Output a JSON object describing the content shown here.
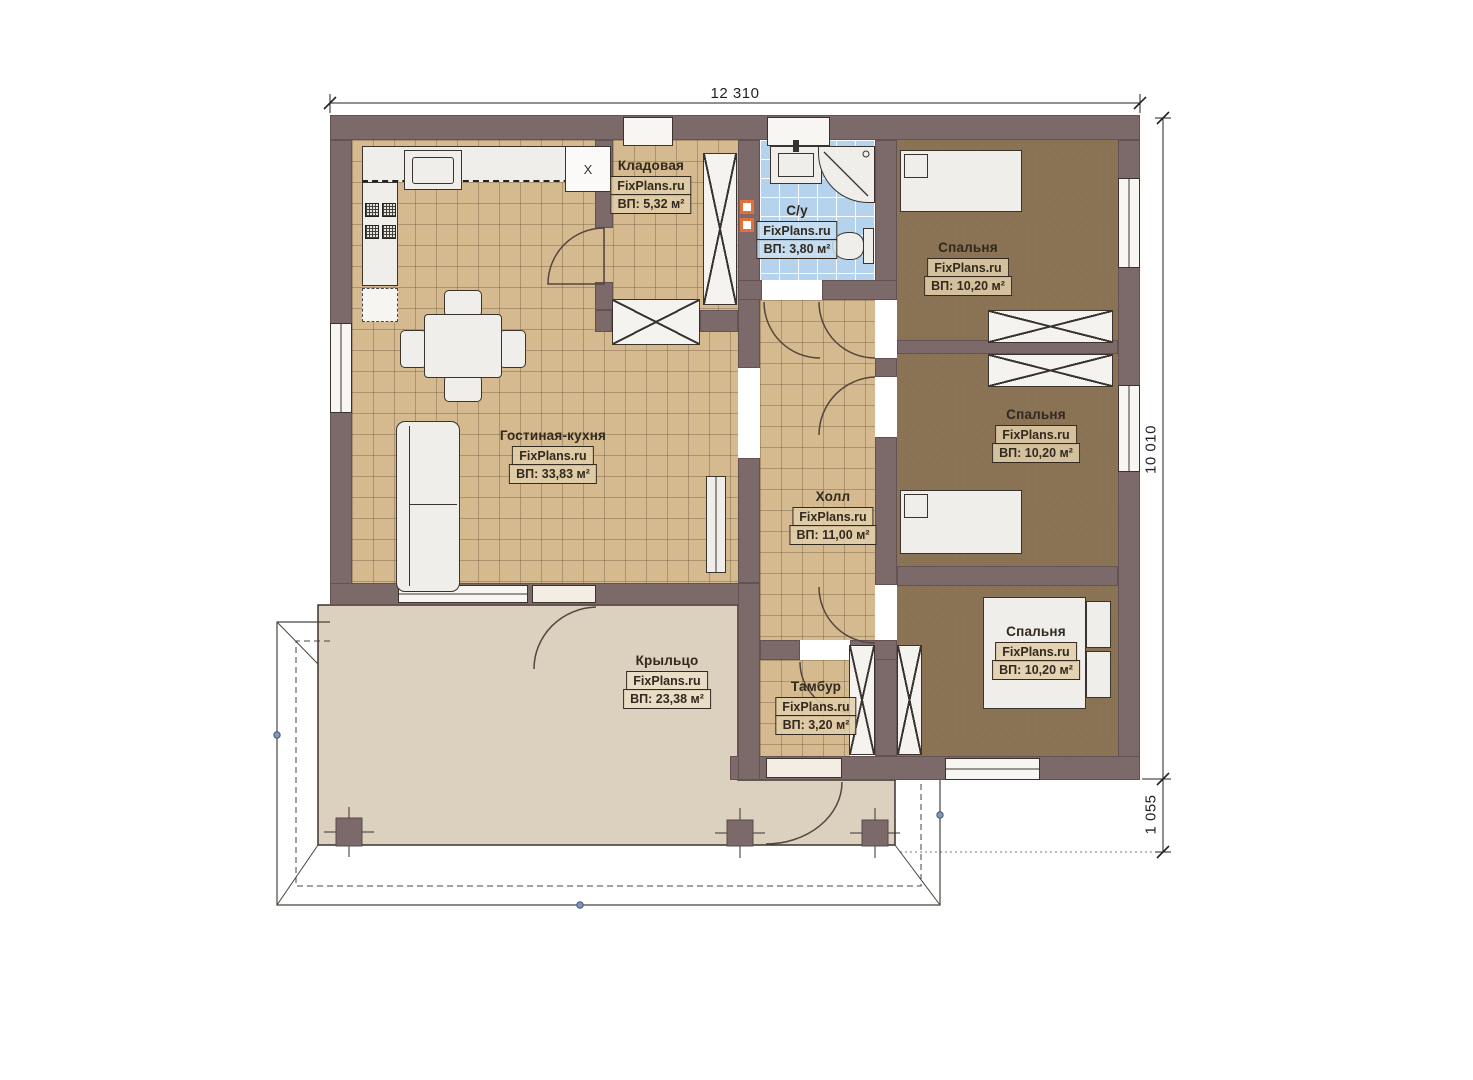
{
  "plan_type": "floor-plan",
  "watermark": "FixPlans.ru",
  "dimensions": {
    "top": "12 310",
    "right": "10 010",
    "bottom_right": "1 055"
  },
  "rooms": [
    {
      "id": "storage",
      "name": "Кладовая",
      "area": "ВП: 5,32 м²"
    },
    {
      "id": "bathroom",
      "name": "С/у",
      "area": "ВП: 3,80 м²"
    },
    {
      "id": "bedroom-1",
      "name": "Спальня",
      "area": "ВП: 10,20 м²"
    },
    {
      "id": "bedroom-2",
      "name": "Спальня",
      "area": "ВП: 10,20 м²"
    },
    {
      "id": "living-kitchen",
      "name": "Гостиная-кухня",
      "area": "ВП: 33,83 м²"
    },
    {
      "id": "hall",
      "name": "Холл",
      "area": "ВП: 11,00 м²"
    },
    {
      "id": "bedroom-3",
      "name": "Спальня",
      "area": "ВП: 10,20 м²"
    },
    {
      "id": "porch",
      "name": "Крыльцо",
      "area": "ВП: 23,38 м²"
    },
    {
      "id": "vestibule",
      "name": "Тамбур",
      "area": "ВП: 3,20 м²"
    }
  ],
  "marks": {
    "appliance": "X"
  },
  "colors": {
    "wall": "#7c6969",
    "tile_beige": "#d4ba8e",
    "tile_blue": "#b5d3ec",
    "bedroom_floor": "#8a7254",
    "porch_floor": "#dcd1bf",
    "accent_marker": "#e2703a",
    "node_dot": "#8096bb"
  }
}
